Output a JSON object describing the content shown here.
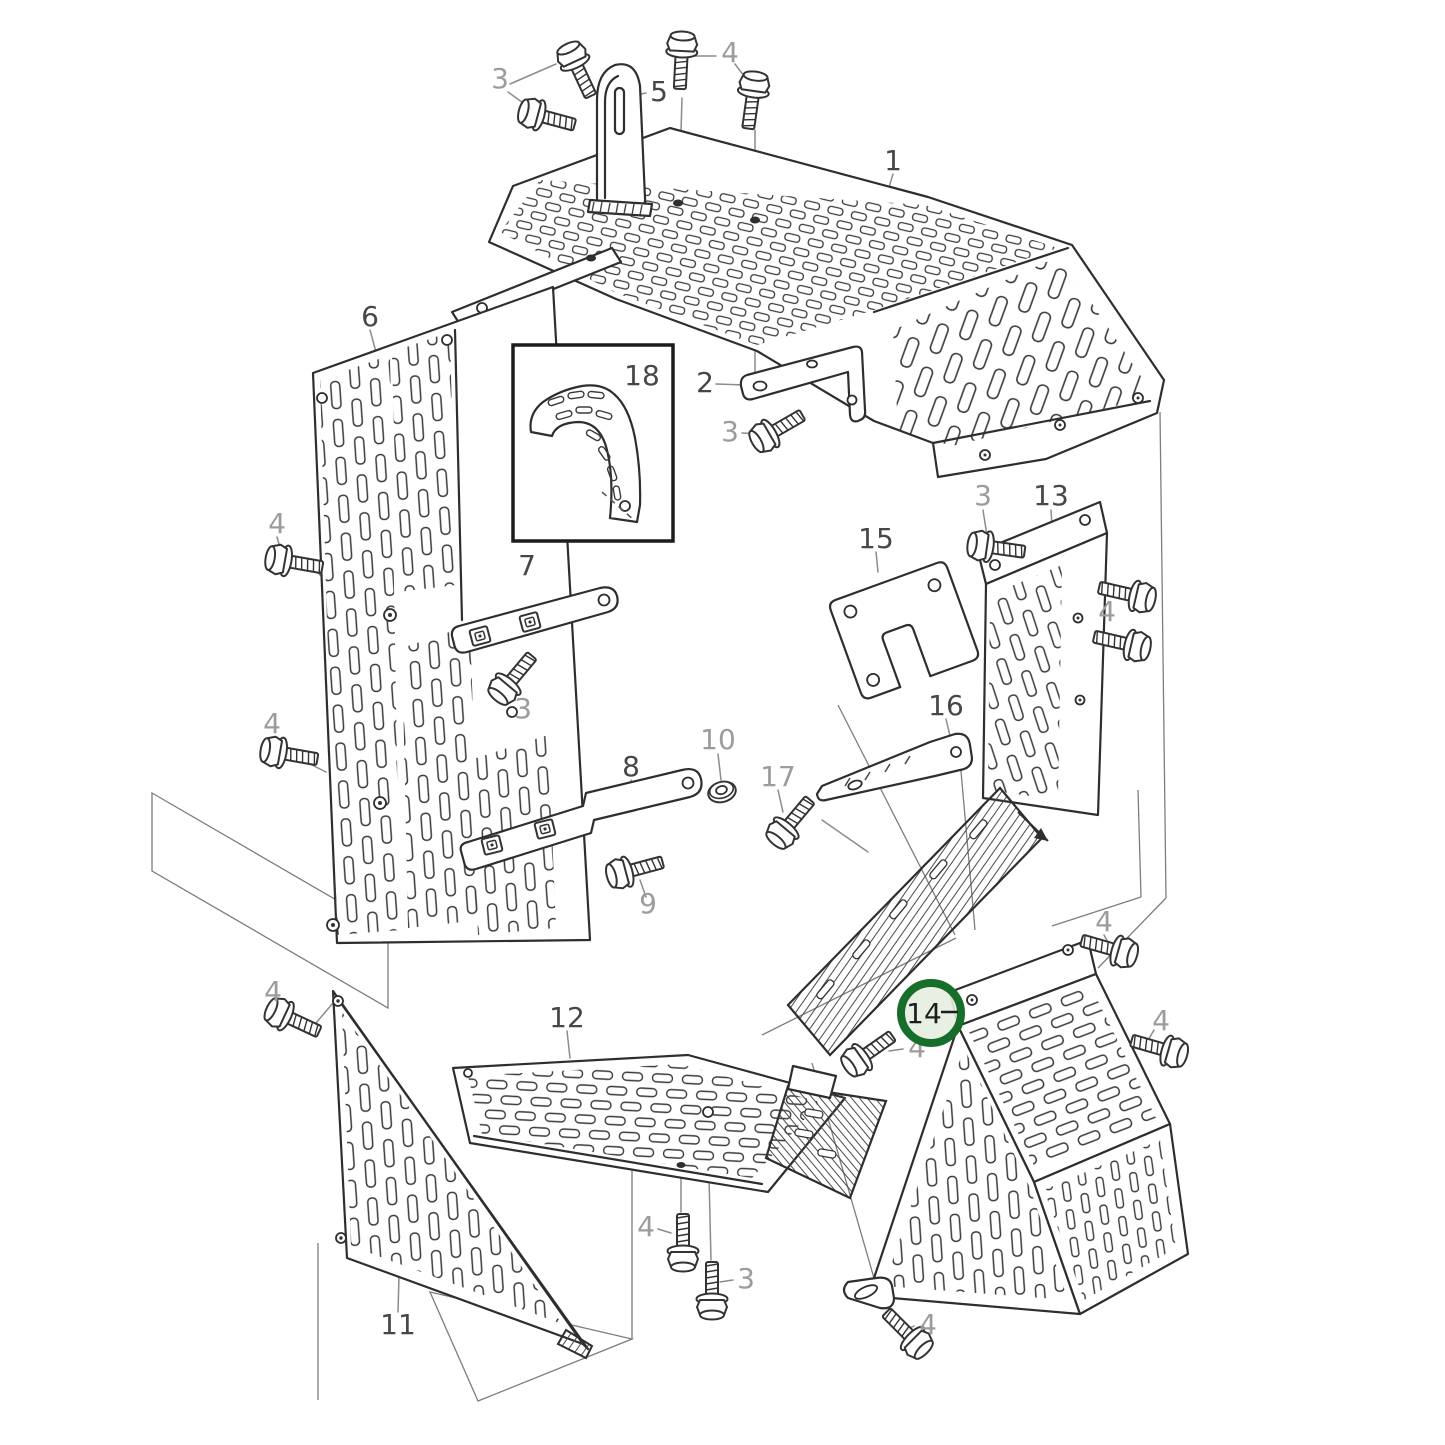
{
  "figure": {
    "kind": "exploded-parts-diagram",
    "background": "#ffffff",
    "outline_color": "#2e2e2e",
    "leader_color": "#8c8c8c",
    "ghost_color": "#7d7d7d"
  },
  "palette": {
    "part_label": "#474747",
    "fastener_label": "#9c9c9c",
    "highlight_ring": "#176e2b",
    "highlight_fill": "#e6eee1",
    "highlight_label": "#1d1d1d"
  },
  "highlight": {
    "label": "14",
    "cx": 931,
    "cy": 1013,
    "r": 30
  },
  "inset": {
    "label": "18",
    "x": 513,
    "y": 345,
    "width": 160,
    "height": 196
  },
  "callouts": [
    {
      "label": "1",
      "x": 893,
      "y": 170,
      "kind": "part"
    },
    {
      "label": "2",
      "x": 705,
      "y": 392,
      "kind": "part"
    },
    {
      "label": "3",
      "x": 500,
      "y": 88,
      "kind": "fastener"
    },
    {
      "label": "3",
      "x": 730,
      "y": 441,
      "kind": "fastener"
    },
    {
      "label": "3",
      "x": 523,
      "y": 718,
      "kind": "fastener"
    },
    {
      "label": "3",
      "x": 983,
      "y": 505,
      "kind": "fastener"
    },
    {
      "label": "3",
      "x": 746,
      "y": 1288,
      "kind": "fastener"
    },
    {
      "label": "4",
      "x": 730,
      "y": 62,
      "kind": "fastener"
    },
    {
      "label": "4",
      "x": 277,
      "y": 533,
      "kind": "fastener"
    },
    {
      "label": "4",
      "x": 272,
      "y": 733,
      "kind": "fastener"
    },
    {
      "label": "4",
      "x": 273,
      "y": 1001,
      "kind": "fastener"
    },
    {
      "label": "4",
      "x": 1107,
      "y": 621,
      "kind": "fastener"
    },
    {
      "label": "4",
      "x": 1104,
      "y": 931,
      "kind": "fastener"
    },
    {
      "label": "4",
      "x": 1161,
      "y": 1030,
      "kind": "fastener"
    },
    {
      "label": "4",
      "x": 917,
      "y": 1057,
      "kind": "fastener"
    },
    {
      "label": "4",
      "x": 928,
      "y": 1334,
      "kind": "fastener"
    },
    {
      "label": "4",
      "x": 646,
      "y": 1236,
      "kind": "fastener"
    },
    {
      "label": "5",
      "x": 659,
      "y": 101,
      "kind": "part"
    },
    {
      "label": "6",
      "x": 370,
      "y": 326,
      "kind": "part"
    },
    {
      "label": "7",
      "x": 527,
      "y": 575,
      "kind": "part"
    },
    {
      "label": "8",
      "x": 631,
      "y": 776,
      "kind": "part"
    },
    {
      "label": "9",
      "x": 648,
      "y": 913,
      "kind": "fastener"
    },
    {
      "label": "10",
      "x": 718,
      "y": 749,
      "kind": "fastener"
    },
    {
      "label": "11",
      "x": 398,
      "y": 1334,
      "kind": "part"
    },
    {
      "label": "12",
      "x": 567,
      "y": 1027,
      "kind": "part"
    },
    {
      "label": "13",
      "x": 1051,
      "y": 505,
      "kind": "part"
    },
    {
      "label": "15",
      "x": 876,
      "y": 548,
      "kind": "part"
    },
    {
      "label": "16",
      "x": 946,
      "y": 715,
      "kind": "part"
    },
    {
      "label": "17",
      "x": 778,
      "y": 786,
      "kind": "fastener"
    },
    {
      "label": "18",
      "x": 642,
      "y": 385,
      "kind": "part"
    }
  ],
  "fasteners": [
    {
      "label": "3",
      "type": "bolt",
      "x": 573,
      "y": 58,
      "angle": -25
    },
    {
      "label": "3",
      "type": "bolt",
      "x": 534,
      "y": 114,
      "angle": -75
    },
    {
      "label": "4",
      "type": "bolt",
      "x": 682,
      "y": 47,
      "angle": 3
    },
    {
      "label": "4",
      "type": "bolt",
      "x": 754,
      "y": 87,
      "angle": 8
    },
    {
      "label": "3",
      "type": "bolt",
      "x": 766,
      "y": 436,
      "angle": -120
    },
    {
      "label": "4",
      "type": "bolt",
      "x": 281,
      "y": 560,
      "angle": -80
    },
    {
      "label": "4",
      "type": "bolt",
      "x": 276,
      "y": 752,
      "angle": -80
    },
    {
      "label": "4",
      "type": "bolt",
      "x": 281,
      "y": 1014,
      "angle": -65
    },
    {
      "label": "3",
      "type": "bolt",
      "x": 505,
      "y": 688,
      "angle": -140
    },
    {
      "label": "9",
      "type": "bolt",
      "x": 622,
      "y": 873,
      "angle": -105
    },
    {
      "label": "17",
      "type": "bolt",
      "x": 783,
      "y": 832,
      "angle": -140
    },
    {
      "label": "3",
      "type": "bolt",
      "x": 983,
      "y": 546,
      "angle": -82
    },
    {
      "label": "4",
      "type": "bolt",
      "x": 1140,
      "y": 597,
      "angle": 103
    },
    {
      "label": "4",
      "type": "bolt",
      "x": 1135,
      "y": 646,
      "angle": 103
    },
    {
      "label": "4",
      "type": "bolt",
      "x": 1122,
      "y": 952,
      "angle": 106
    },
    {
      "label": "4",
      "type": "bolt",
      "x": 1172,
      "y": 1052,
      "angle": 106
    },
    {
      "label": "4",
      "type": "bolt",
      "x": 858,
      "y": 1060,
      "angle": -125
    },
    {
      "label": "4",
      "type": "bolt",
      "x": 916,
      "y": 1342,
      "angle": 135
    },
    {
      "label": "4",
      "type": "bolt",
      "x": 683,
      "y": 1256,
      "angle": 180
    },
    {
      "label": "3",
      "type": "bolt",
      "x": 712,
      "y": 1304,
      "angle": 180
    },
    {
      "label": "10",
      "type": "washer",
      "x": 722,
      "y": 792,
      "angle": -15
    }
  ]
}
